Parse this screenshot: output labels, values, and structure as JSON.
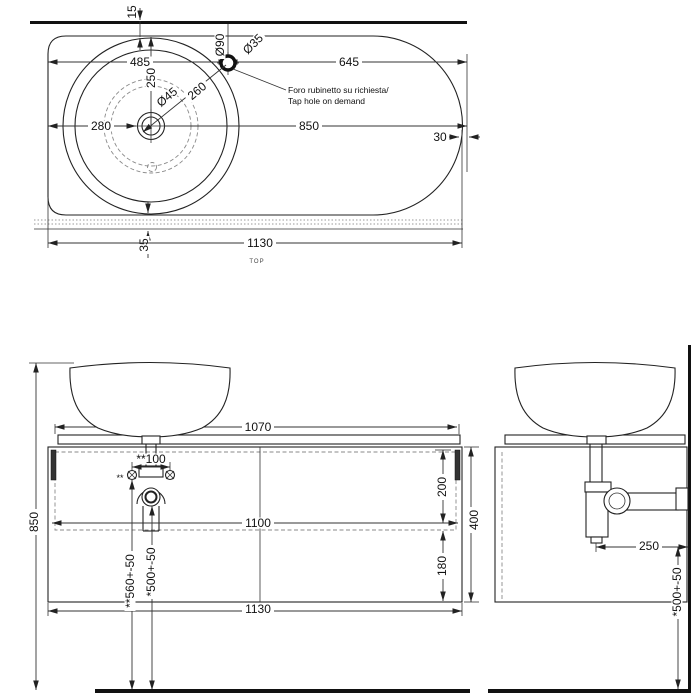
{
  "colors": {
    "line": "#222222",
    "hidden": "#8a8a8a",
    "background": "#ffffff"
  },
  "top_view": {
    "label": "TOP",
    "dims": {
      "wall_offset": "15",
      "edge_to_tap": "485",
      "edge_to_center": "250",
      "left_to_center": "280",
      "center_to_right": "850",
      "tap_to_right": "645",
      "rim_offset": "30",
      "back_gap": "35",
      "total_width": "1130",
      "tap_ring": "Ø90",
      "tap_hole": "Ø35",
      "drain": "Ø45",
      "center_to_tap": "260"
    },
    "note": {
      "line1": "Foro rubinetto su richiesta/",
      "line2": "Tap hole on demand"
    }
  },
  "front_view": {
    "dims": {
      "height": "850",
      "shelf_width": "1070",
      "drain_offset": "**100",
      "top_to_rail": "200",
      "inner_width": "1100",
      "rail_to_bottom": "180",
      "cabinet_height": "400",
      "total_width": "1130",
      "screw_height": "**560+-50",
      "drain_height": "*500+-50"
    },
    "marks": {
      "screws": "**"
    }
  },
  "side_view": {
    "dims": {
      "drain_to_wall": "250",
      "drain_height": "*500+-50"
    }
  }
}
